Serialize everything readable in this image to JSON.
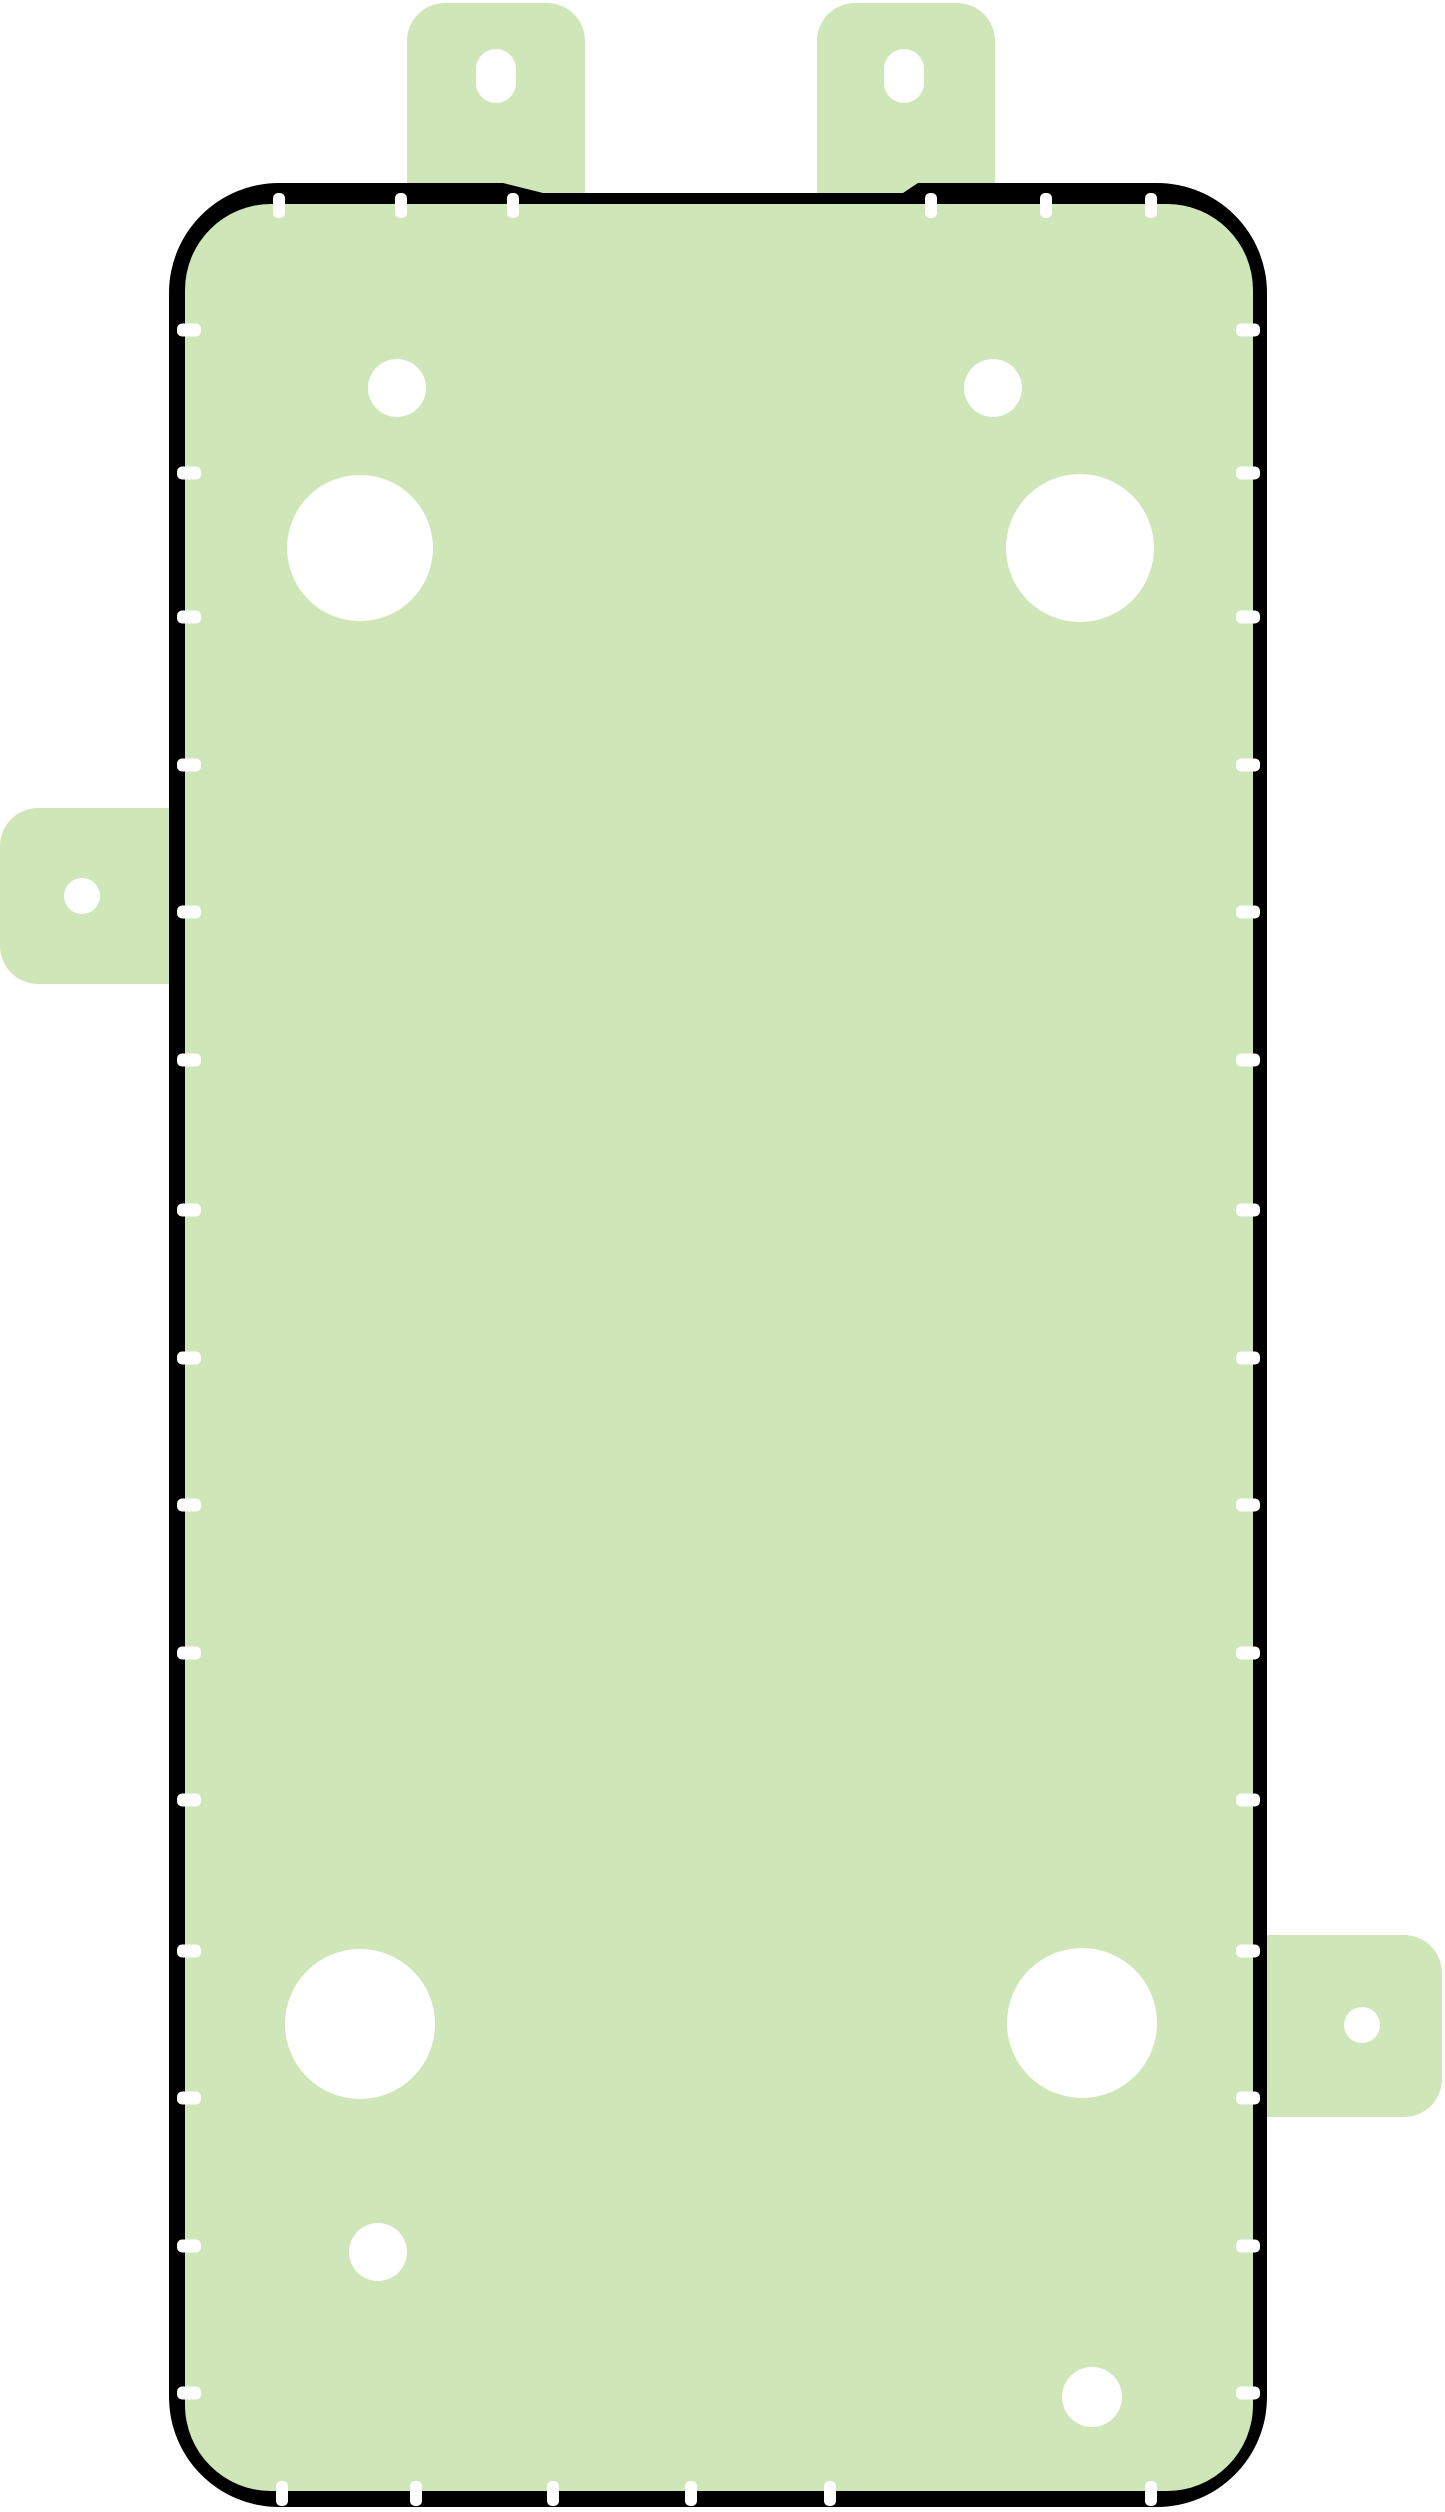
{
  "canvas": {
    "width": 1445,
    "height": 2512,
    "background": "#ffffff"
  },
  "palette": {
    "adhesive_green": "#cfe6b8",
    "outline_black": "#000000",
    "cutout_white": "#ffffff"
  },
  "body": {
    "outer": {
      "left": 169,
      "top": 183,
      "right": 1267,
      "bottom": 2507,
      "corner_radius": 110
    },
    "top_profile": [
      [
        279,
        183
      ],
      [
        503,
        183
      ],
      [
        543,
        193
      ],
      [
        903,
        193
      ],
      [
        918,
        183
      ],
      [
        1157,
        183
      ]
    ],
    "inner": {
      "left": 185,
      "top": 204,
      "right": 1253,
      "bottom": 2491,
      "corner_radius": 86
    }
  },
  "tabs": [
    {
      "name": "pull-tab-top-left",
      "side": "top",
      "x": 407,
      "y": 3,
      "width": 178,
      "height": 255,
      "corner_radius": 38,
      "hole": {
        "shape": "slot",
        "cx": 496,
        "cy": 76,
        "width": 40,
        "height": 54
      }
    },
    {
      "name": "pull-tab-top-right",
      "side": "top",
      "x": 817,
      "y": 3,
      "width": 178,
      "height": 255,
      "corner_radius": 38,
      "hole": {
        "shape": "slot",
        "cx": 904,
        "cy": 76,
        "width": 40,
        "height": 54
      }
    },
    {
      "name": "pull-tab-left",
      "side": "left",
      "x": 0,
      "y": 808,
      "width": 225,
      "height": 176,
      "corner_radius": 38,
      "hole": {
        "shape": "circle",
        "cx": 82,
        "cy": 896,
        "r": 18
      }
    },
    {
      "name": "pull-tab-right",
      "side": "right",
      "x": 1213,
      "y": 1935,
      "width": 229,
      "height": 182,
      "corner_radius": 38,
      "hole": {
        "shape": "circle",
        "cx": 1362,
        "cy": 2025,
        "r": 18
      }
    }
  ],
  "cutouts": [
    {
      "name": "cutout-small-upper-left",
      "cx": 397,
      "cy": 388,
      "r": 29
    },
    {
      "name": "cutout-small-upper-right",
      "cx": 993,
      "cy": 388,
      "r": 29
    },
    {
      "name": "cutout-large-upper-left",
      "cx": 360,
      "cy": 548,
      "r": 73
    },
    {
      "name": "cutout-large-upper-right",
      "cx": 1080,
      "cy": 548,
      "r": 74
    },
    {
      "name": "cutout-large-lower-left",
      "cx": 360,
      "cy": 2024,
      "r": 75
    },
    {
      "name": "cutout-large-lower-right",
      "cx": 1082,
      "cy": 2023,
      "r": 75
    },
    {
      "name": "cutout-small-lower-left",
      "cx": 378,
      "cy": 2252,
      "r": 29
    },
    {
      "name": "cutout-small-lower-right",
      "cx": 1092,
      "cy": 2397,
      "r": 30
    }
  ],
  "alignment_ticks": {
    "top": {
      "xs": [
        279,
        401,
        513,
        931,
        1046,
        1151
      ],
      "y": 193,
      "width": 12,
      "height": 25,
      "radius": 5
    },
    "bottom": {
      "xs": [
        282,
        416,
        553,
        691,
        830,
        1151
      ],
      "y": 2481,
      "width": 12,
      "height": 25,
      "radius": 5
    },
    "left": {
      "ys": [
        330,
        473,
        617,
        765,
        912,
        1060,
        1210,
        1358,
        1505,
        1653,
        1800,
        1951,
        2098,
        2246,
        2393
      ],
      "x": 177,
      "width": 24,
      "height": 13,
      "radius": 5
    },
    "right": {
      "ys": [
        330,
        473,
        617,
        765,
        912,
        1060,
        1210,
        1358,
        1505,
        1653,
        1800,
        1951,
        2098,
        2246,
        2393
      ],
      "x": 1236,
      "width": 24,
      "height": 13,
      "radius": 5
    }
  }
}
